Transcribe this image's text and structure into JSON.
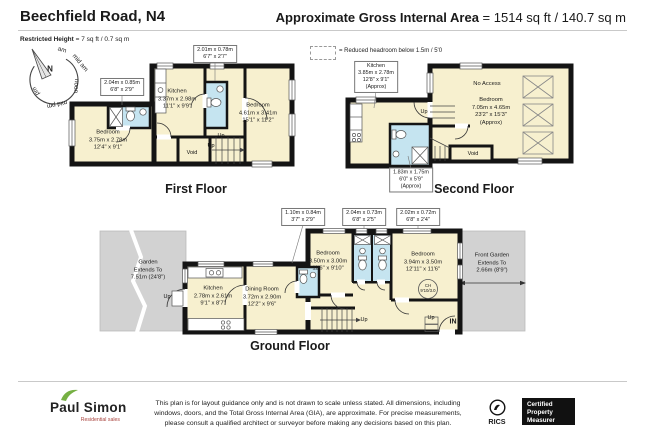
{
  "header": {
    "title": "Beechfield Road, N4",
    "gia_label": "Approximate Gross Internal Area",
    "gia_value": "= 1514 sq ft / 140.7 sq m",
    "restricted_height_label": "Restricted Height",
    "restricted_height_value": "= 7 sq ft / 0.7 sq m"
  },
  "compass": {
    "north_label": "N",
    "arc_labels": [
      "am",
      "mid am",
      "noon",
      "mid pm",
      "pm"
    ]
  },
  "floors": {
    "first": {
      "title": "First Floor",
      "bedroom_left": {
        "name": "Bedroom",
        "metric": "3.75m x 2.78m",
        "imperial": "12'4\" x 9'1\""
      },
      "kitchen": {
        "name": "Kitchen",
        "metric": "3.37m x 2.98m",
        "imperial": "11'1\" x 9'9\""
      },
      "bedroom_right": {
        "name": "Bedroom",
        "metric": "4.61m x 3.41m",
        "imperial": "15'1\" x 11'2\""
      },
      "dim_box_left": {
        "metric": "2.04m x 0.85m",
        "imperial": "6'8\" x 2'9\""
      },
      "dim_box_right": {
        "metric": "2.01m x 0.78m",
        "imperial": "6'7\" x 2'7\""
      },
      "up_label_1": "Up",
      "up_label_2": "Up",
      "void_label": "Void"
    },
    "second": {
      "title": "Second Floor",
      "legend_text": "= Reduced headroom below 1.5m / 5'0",
      "kitchen_box": {
        "name": "Kitchen",
        "metric": "3.85m x 2.78m",
        "imperial": "12'8\" x 9'1\"",
        "approx": "(Approx)"
      },
      "bath_box": {
        "metric": "1.83m x 1.75m",
        "imperial": "6'0\" x 5'9\"",
        "approx": "(Approx)"
      },
      "no_access_label": "No Access",
      "bedroom": {
        "name": "Bedroom",
        "metric": "7.05m x 4.65m",
        "imperial": "23'2\" x 15'3\"",
        "approx": "(Approx)"
      },
      "void_label": "Void",
      "up_label": "Up"
    },
    "ground": {
      "title": "Ground Floor",
      "garden": {
        "line1": "Garden",
        "line2": "Extends To",
        "line3": "7.51m (24'8\")"
      },
      "front_garden": {
        "line1": "Front Garden",
        "line2": "Extends To",
        "line3": "2.66m (8'9\")"
      },
      "kitchen": {
        "name": "Kitchen",
        "metric": "2.78m x 2.61m",
        "imperial": "9'1\" x 8'7\""
      },
      "dining_room": {
        "name": "Dining Room",
        "metric": "3.72m x 2.90m",
        "imperial": "12'2\" x 9'6\""
      },
      "bedroom_middle": {
        "name": "Bedroom",
        "metric": "3.50m x 3.00m",
        "imperial": "11'6\" x 9'10\""
      },
      "bedroom_front": {
        "name": "Bedroom",
        "metric": "3.94m x 3.50m",
        "imperial": "12'11\" x 11'6\""
      },
      "dim_box_1": {
        "metric": "1.10m x 0.84m",
        "imperial": "3'7\" x 2'9\""
      },
      "dim_box_2": {
        "metric": "2.04m x 0.73m",
        "imperial": "6'8\" x 2'5\""
      },
      "dim_box_3": {
        "metric": "2.02m x 0.72m",
        "imperial": "6'8\" x 2'4\""
      },
      "ceiling_height": {
        "line1": "CH",
        "line2": "9'10/3.0"
      },
      "up_rear": "Up",
      "up_stairs": "Up",
      "up_front": "Up",
      "in_label": "IN"
    }
  },
  "footer": {
    "disclaimer_line1": "This plan is for layout guidance only and is not drawn to scale unless stated. All dimensions, including",
    "disclaimer_line2": "windows, doors, and the Total Gross Internal Area (GIA), are approximate. For precise measurements,",
    "disclaimer_line3": "please consult a qualified architect or surveyor before making any decisions based on this plan.",
    "agency": {
      "name": "Paul Simon",
      "tagline": "Residential sales"
    },
    "rics_label": "RICS",
    "badge": {
      "line1": "Certified",
      "line2": "Property",
      "line3": "Measurer"
    }
  },
  "colors": {
    "room_fill": "#f7f0cf",
    "bath_fill": "#c5e4f0",
    "garden_fill": "#d2d2d2",
    "wall": "#141414",
    "logo_green": "#76b043",
    "logo_red": "#a8423c"
  }
}
